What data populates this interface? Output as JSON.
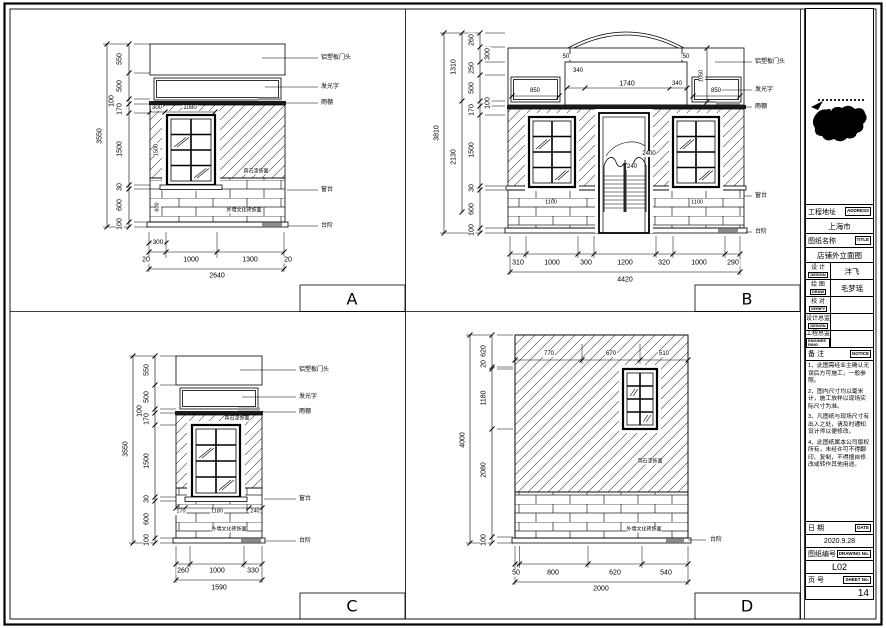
{
  "title_block": {
    "address_label": "工程地址",
    "address_tag": "ADDRESS",
    "address_value": "上海市",
    "title_label": "图纸名称",
    "title_tag": "TITLE",
    "title_value": "店铺外立面图",
    "design_label": "设 计",
    "design_tag": "DESIGN",
    "design_value": "沣飞",
    "draw_label": "绘 图",
    "draw_tag": "DRAW",
    "draw_value": "毛梦瑶",
    "verify_label": "校 对",
    "verify_tag": "VERIFY",
    "verify_value": "",
    "design_director_label": "设计总监",
    "design_director_tag": "DESIGN",
    "design_director_value": "",
    "engineer_label": "工程总监",
    "engineer_tag": "ENGINEE RING",
    "engineer_value": "",
    "notice_label": "备 注",
    "notice_tag": "NOTICE",
    "notes": [
      "1、此图需经业主确认无误后方可施工，一般参照。",
      "2、图内尺寸均以毫米计，施工放样以现场实际尺寸为准。",
      "3、凡图纸与现场尺寸有出入之处，请及时通知设计师以便修改。",
      "4、此图纸属本公司版权所有，未经许可不得翻印、复制，不得擅自修改或转作其他用途。"
    ],
    "date_label": "日 期",
    "date_tag": "DATE",
    "date_value": "2020.9.28",
    "drawing_no_label": "图纸编号",
    "drawing_no_tag": "DRAWING No.",
    "drawing_no_value": "L02",
    "sheet_no_label": "页 号",
    "sheet_no_tag": "SHEET No.",
    "sheet_no_value": "14"
  },
  "views": {
    "A": {
      "letter": "A",
      "outer_height": "3550",
      "left_dims": [
        "550",
        "500",
        "100",
        "170",
        "1500",
        "30",
        "600",
        "100"
      ],
      "window_top_dims": [
        "300",
        "1080"
      ],
      "window_side_dims": [
        "1500",
        "600"
      ],
      "bottom_sub": "300",
      "bottom_dims": [
        "20",
        "1000",
        "1300",
        "20"
      ],
      "bottom_total": "2640",
      "leaders": [
        "铝塑板门头",
        "发光字",
        "雨棚",
        "窗台",
        "台阶"
      ],
      "wall_finish": "真石漆饰面",
      "brick_finish": "外墙文化砖饰面"
    },
    "B": {
      "letter": "B",
      "outer_height": "3810",
      "mid_dims": [
        "1310",
        "2130"
      ],
      "left_dims": [
        "260",
        "300",
        "250",
        "500",
        "100",
        "170",
        "1500",
        "30",
        "600",
        "100"
      ],
      "top_dims": [
        "50",
        "340",
        "1740",
        "340",
        "50"
      ],
      "box_dims": [
        "850",
        "850"
      ],
      "side_dim": "1050",
      "door_dims": [
        "2400",
        "240"
      ],
      "window_bottom_dims": [
        "1100",
        "1100"
      ],
      "bottom_dims": [
        "310",
        "1000",
        "300",
        "1200",
        "320",
        "1000",
        "290"
      ],
      "bottom_total": "4420",
      "leaders": [
        "铝塑板门头",
        "发光字",
        "雨棚",
        "窗台",
        "台阶"
      ]
    },
    "C": {
      "letter": "C",
      "outer_height": "3550",
      "left_dims": [
        "550",
        "500",
        "100",
        "170",
        "1500",
        "30",
        "600",
        "100"
      ],
      "sill_dims": [
        "170",
        "1180",
        "240"
      ],
      "bottom_dims": [
        "260",
        "1000",
        "330"
      ],
      "bottom_total": "1590",
      "leaders": [
        "铝塑板门头",
        "发光字",
        "雨棚",
        "窗台",
        "台阶"
      ],
      "wall_finish": "真石漆饰面",
      "brick_finish": "外墙文化砖饰面"
    },
    "D": {
      "letter": "D",
      "outer_height": "4000",
      "left_dims": [
        "620",
        "20",
        "1180",
        "2080",
        "100"
      ],
      "top_dims": [
        "770",
        "670",
        "510"
      ],
      "bottom_dims": [
        "50",
        "800",
        "620",
        "540"
      ],
      "bottom_total": "2000",
      "leaders": [
        "台阶"
      ],
      "wall_finish": "真石漆饰面",
      "brick_finish": "外墙文化砖饰面"
    }
  }
}
